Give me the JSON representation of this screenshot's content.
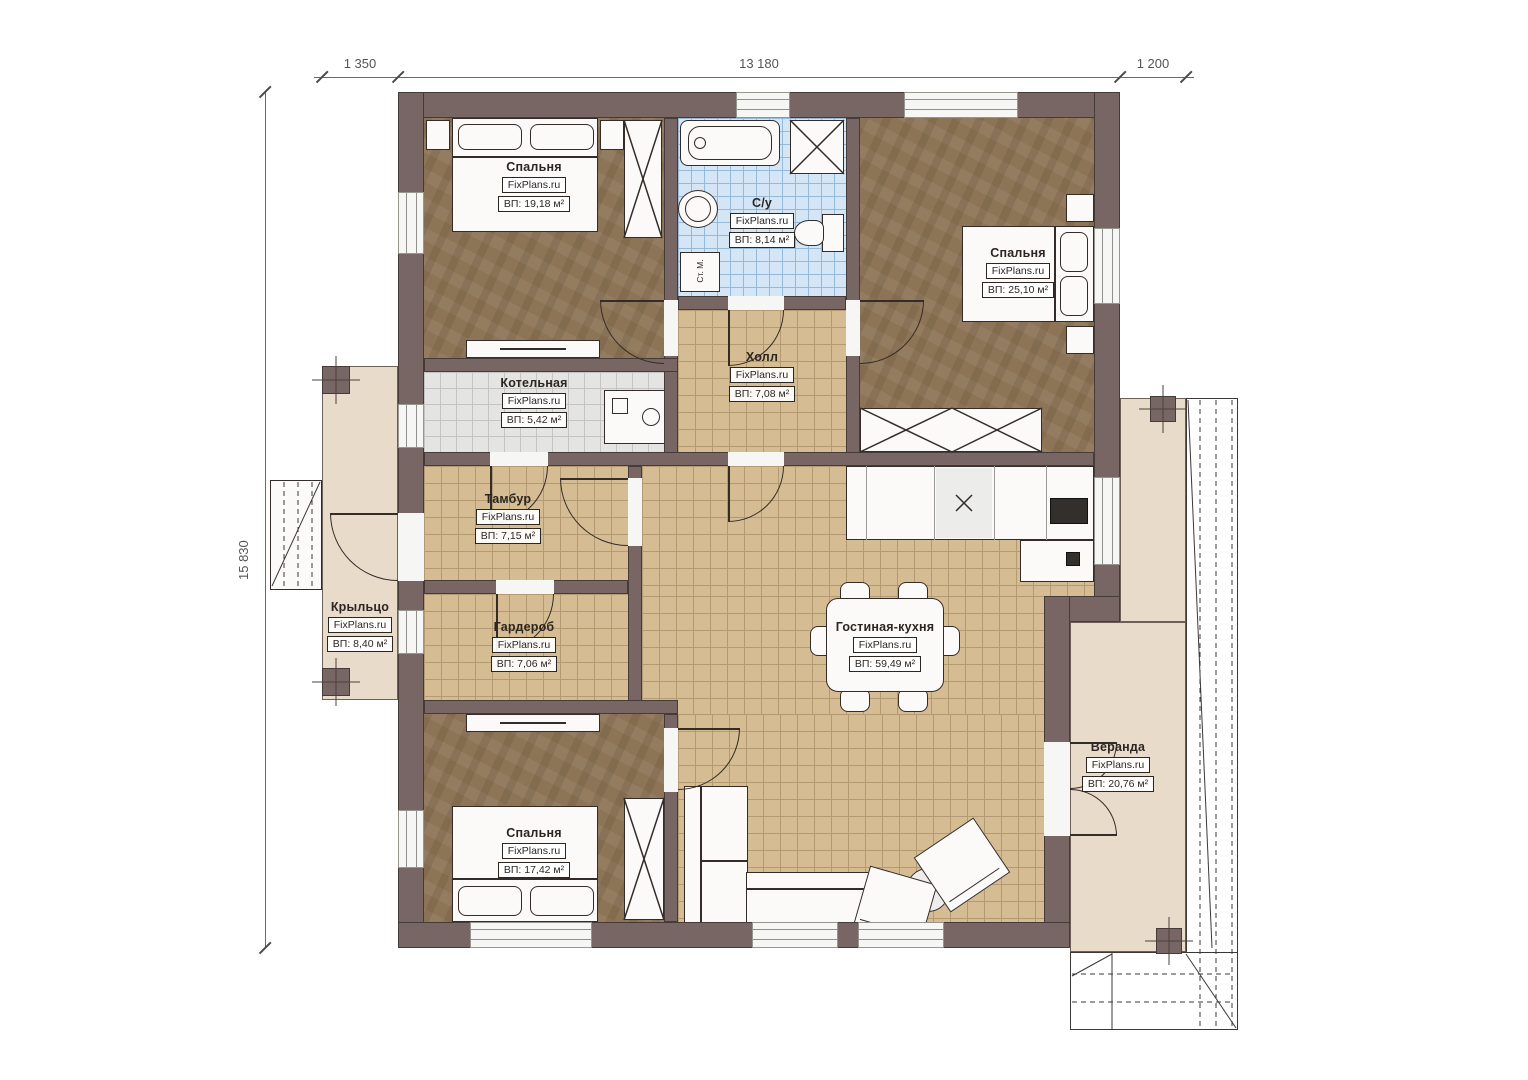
{
  "brand": "FixPlans.ru",
  "dimensions": {
    "top_left": "1 350",
    "top_center": "13 180",
    "top_right": "1 200",
    "left_total": "15 830"
  },
  "rooms": [
    {
      "id": "bedroom-1",
      "name": "Спальня",
      "brand": "FixPlans.ru",
      "area": "ВП: 19,18 м²"
    },
    {
      "id": "bathroom",
      "name": "С/у",
      "brand": "FixPlans.ru",
      "area": "ВП: 8,14 м²"
    },
    {
      "id": "bedroom-2",
      "name": "Спальня",
      "brand": "FixPlans.ru",
      "area": "ВП: 25,10 м²"
    },
    {
      "id": "hall",
      "name": "Холл",
      "brand": "FixPlans.ru",
      "area": "ВП: 7,08 м²"
    },
    {
      "id": "boiler-room",
      "name": "Котельная",
      "brand": "FixPlans.ru",
      "area": "ВП: 5,42 м²"
    },
    {
      "id": "vestibule",
      "name": "Тамбур",
      "brand": "FixPlans.ru",
      "area": "ВП: 7,15 м²"
    },
    {
      "id": "wardrobe-room",
      "name": "Гардероб",
      "brand": "FixPlans.ru",
      "area": "ВП: 7,06 м²"
    },
    {
      "id": "porch",
      "name": "Крыльцо",
      "brand": "FixPlans.ru",
      "area": "ВП: 8,40 м²"
    },
    {
      "id": "living-kitchen",
      "name": "Гостиная-кухня",
      "brand": "FixPlans.ru",
      "area": "ВП: 59,49 м²"
    },
    {
      "id": "veranda",
      "name": "Веранда",
      "brand": "FixPlans.ru",
      "area": "ВП: 20,76 м²"
    },
    {
      "id": "bedroom-3",
      "name": "Спальня",
      "brand": "FixPlans.ru",
      "area": "ВП: 17,42 м²"
    }
  ],
  "annotations": {
    "washing_machine": "Ст. М."
  },
  "colors": {
    "wall": "#776663",
    "floor_tile_tan": "#d6bc92",
    "floor_wood_brown": "#8d7456",
    "floor_tile_blue": "#d4e5f5",
    "floor_tile_gray": "#e4e4e2",
    "deck_beige": "#e8dbc9"
  }
}
